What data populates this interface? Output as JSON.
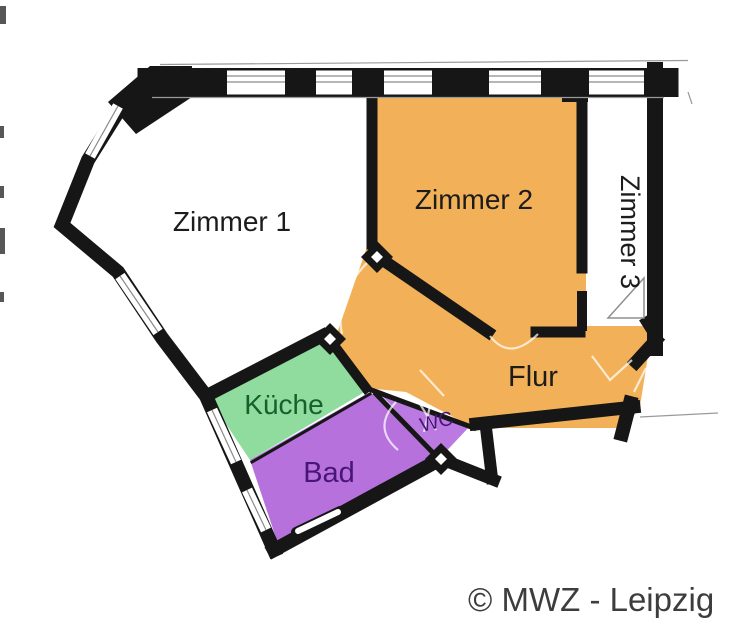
{
  "floorplan": {
    "rooms": [
      {
        "name": "Zimmer 1",
        "color": "#ffffff",
        "label_color": "#1c1c1c"
      },
      {
        "name": "Zimmer 2",
        "color": "#f2b158",
        "label_color": "#1c1c1c"
      },
      {
        "name": "Zimmer 3",
        "color": "#ffffff",
        "label_color": "#1c1c1c"
      },
      {
        "name": "Flur",
        "color": "#f2b158",
        "label_color": "#1c1c1c"
      },
      {
        "name": "Küche",
        "color": "#8fdc9e",
        "label_color": "#17602b"
      },
      {
        "name": "Bad",
        "color": "#b671dd",
        "label_color": "#471677"
      },
      {
        "name": "WC",
        "color": "#bb7ae2",
        "label_color": "#471677"
      }
    ],
    "colors": {
      "wall": "#161616",
      "window_line": "#8a8a8a",
      "hairline": "#9a9a9a",
      "door_swing": "#8f8f8f",
      "background": "#ffffff"
    },
    "copyright": "© MWZ - Leipzig",
    "copyright_color": "#3d3d3d"
  }
}
